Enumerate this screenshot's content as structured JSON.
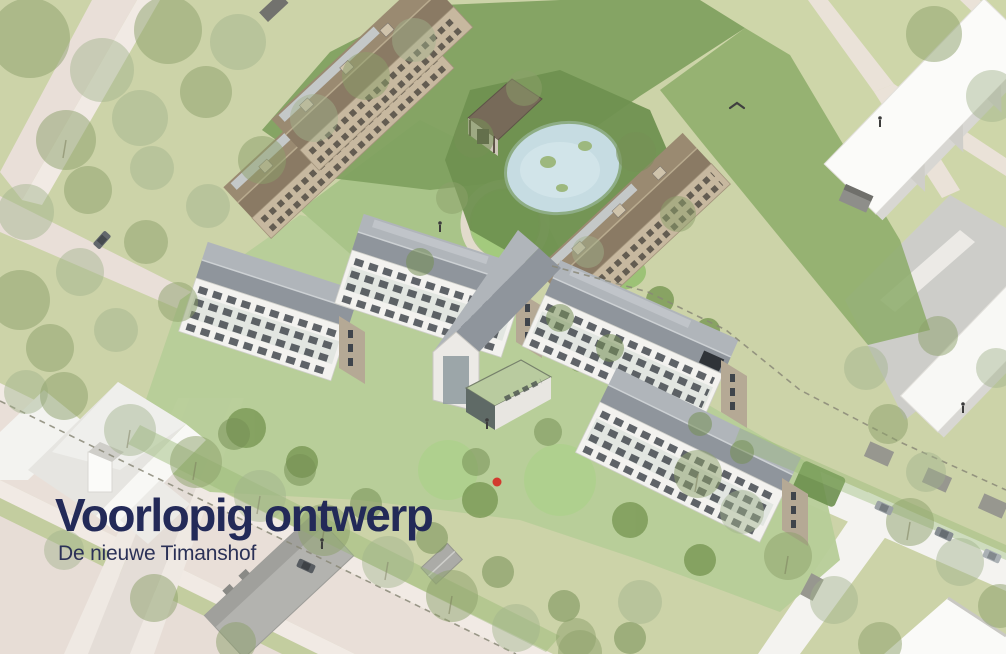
{
  "page": {
    "title": "Voorlopig ontwerp",
    "subtitle": "De nieuwe Timanshof"
  },
  "scene": {
    "kind": "axonometric architectural site rendering of a housing complex",
    "palette": {
      "title_text": "#232a58",
      "subtitle_text": "#2b3157",
      "grass": "#ccd3a8",
      "lawn": "#b7cd98",
      "garden_dark": "#6f9150",
      "hedge": "#7fa05e",
      "road_beige": "#e9dfd8",
      "road_white": "#f4f3f0",
      "path_light": "#f1eae4",
      "pond_blue": "#c9dfe7",
      "roof_gray_near": "#8f959c",
      "roof_gray_far": "#b0b5ba",
      "facade_white": "#f3f2ef",
      "gable_tan": "#b5a995",
      "window_dark": "#3f444b",
      "brown_roof_near": "#8a7a64",
      "brown_roof_far": "#9a8a71",
      "brown_facade": "#c7b89f",
      "white_building": "#fafaf8",
      "building_shadow": "#d8d7d3",
      "gray_box": "#b3b3af",
      "pavement_gray": "#cdcdc9",
      "tree_canopy": "#8ba06a",
      "red_marker": "#d23a2e"
    }
  }
}
